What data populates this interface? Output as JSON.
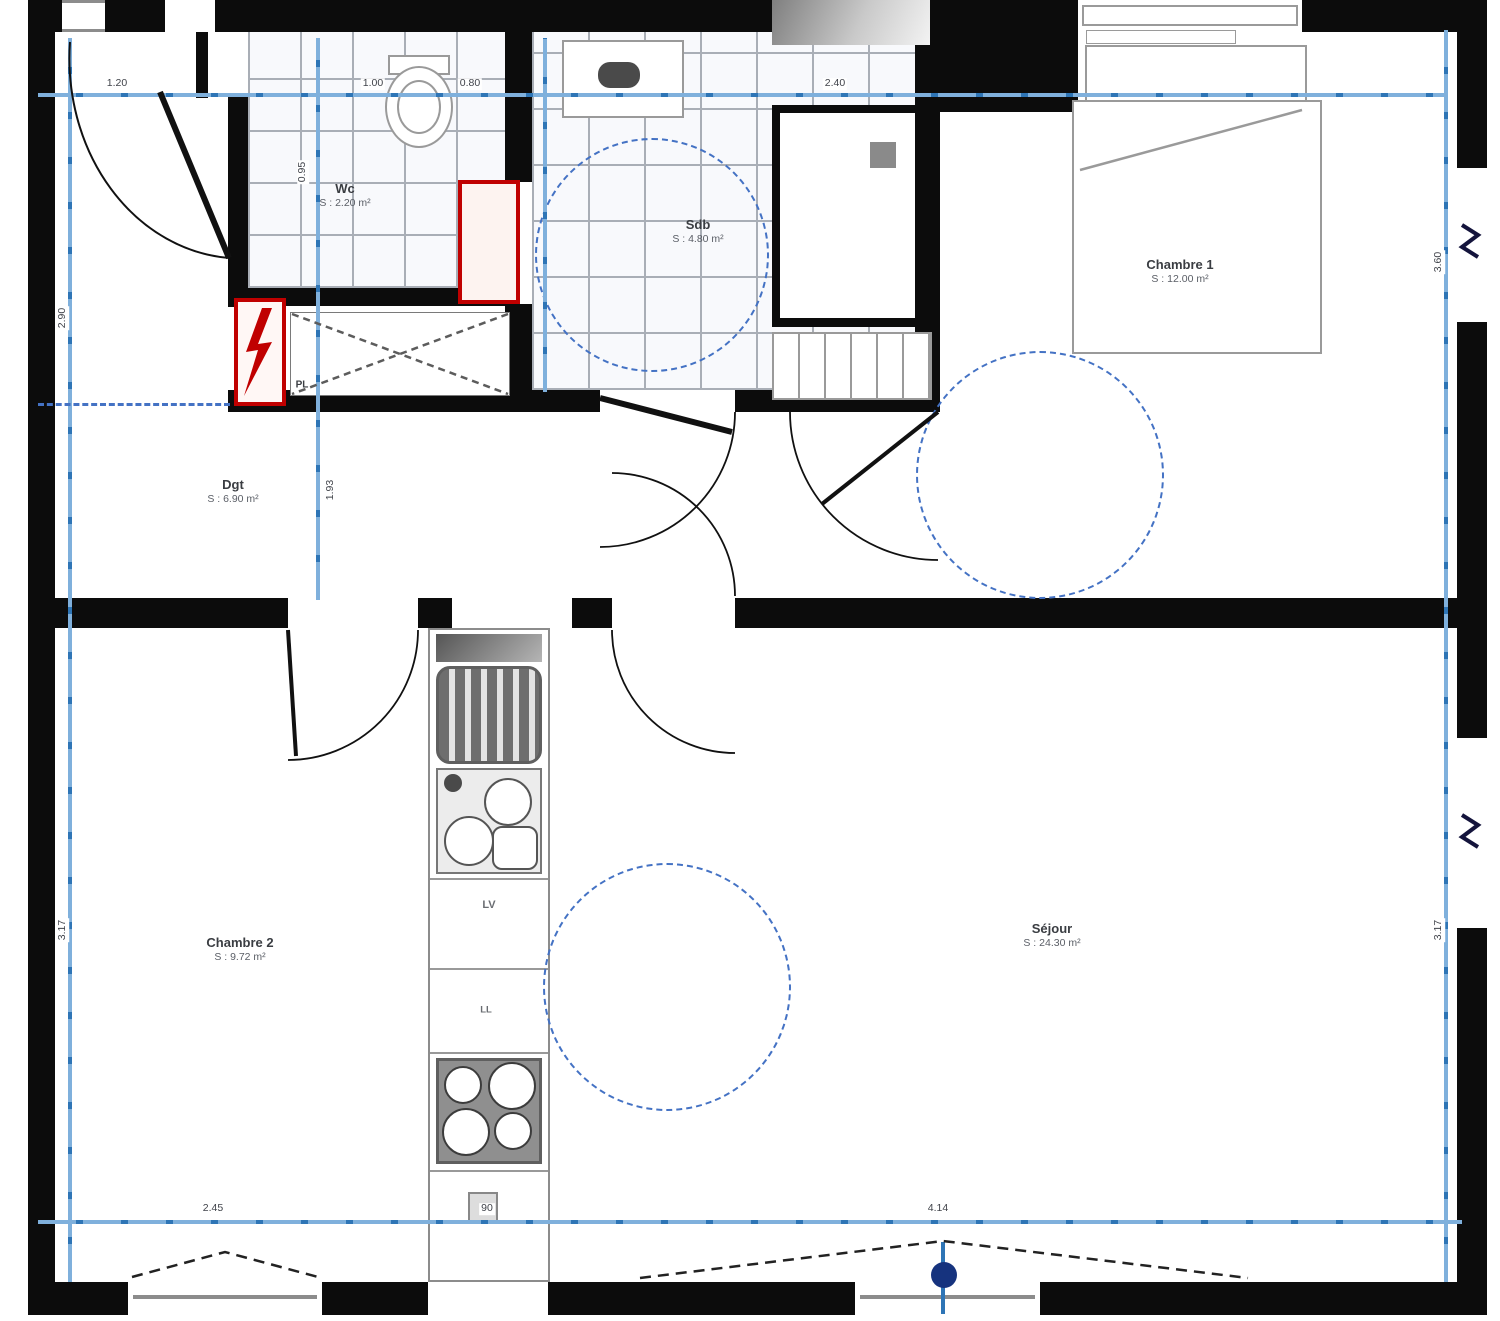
{
  "rooms": {
    "wc": {
      "name": "Wc",
      "area": "S : 2.20 m²"
    },
    "sdb": {
      "name": "Sdb",
      "area": "S : 4.80 m²"
    },
    "chambre1": {
      "name": "Chambre 1",
      "area": "S : 12.00 m²"
    },
    "dgt": {
      "name": "Dgt",
      "area": "S : 6.90 m²"
    },
    "chambre2": {
      "name": "Chambre 2",
      "area": "S : 9.72 m²"
    },
    "sejour": {
      "name": "Séjour",
      "area": "S : 24.30 m²"
    }
  },
  "appliances": {
    "dishwasher_label": "LV",
    "washer_label": "LL",
    "closet_label": "PL"
  },
  "dims": [
    {
      "text": "1.20"
    },
    {
      "text": "1.00"
    },
    {
      "text": "0.80"
    },
    {
      "text": "2.40"
    },
    {
      "text": "2.45"
    },
    {
      "text": "90"
    },
    {
      "text": "4.14"
    },
    {
      "text": "2.90"
    },
    {
      "text": "3.17"
    },
    {
      "text": "3.60"
    },
    {
      "text": "3.17"
    },
    {
      "text": "0.95"
    },
    {
      "text": "1.93"
    }
  ],
  "colors": {
    "wall_black": "#0c0c0c",
    "dimension_blue": "#7fb0dc",
    "tick_blue": "#2e75b6",
    "accessibility_circle_blue": "#4472c4",
    "door_marker_blue": "#16337e",
    "highlight_red": "#c00000",
    "tile_gray": "#a9aeb6"
  }
}
